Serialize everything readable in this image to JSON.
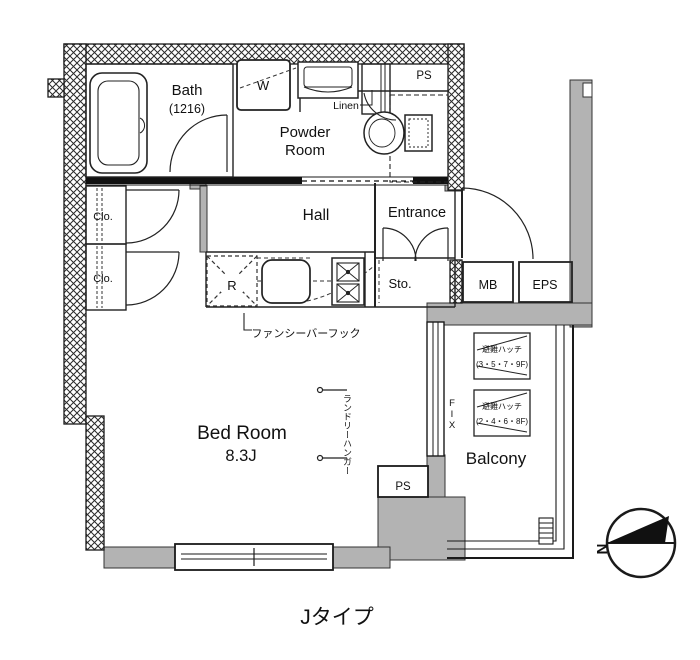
{
  "title": "Jタイプ",
  "labels": {
    "bath": "Bath",
    "bath_size": "(1216)",
    "powder_line1": "Powder",
    "powder_line2": "Room",
    "washer": "W",
    "linen": "Linen",
    "ps_top": "PS",
    "hall": "Hall",
    "entrance": "Entrance",
    "closet_upper": "Clo.",
    "closet_lower": "Clo.",
    "refrigerator": "R",
    "storage": "Sto.",
    "meter_box": "MB",
    "eps": "EPS",
    "bedroom": "Bed Room",
    "bedroom_size": "8.3J",
    "balcony": "Balcony",
    "ps_bottom": "PS",
    "fix_window": "FIX",
    "fancy_bar_hook": "ファンシーバーフック",
    "laundry_hanger": "ランドリーハンガー",
    "hatch_upper_name": "避難ハッチ",
    "hatch_upper_floors": "(3・5・7・9F)",
    "hatch_lower_name": "避難ハッチ",
    "hatch_lower_floors": "(2・4・6・8F)",
    "compass_north": "N"
  },
  "colors": {
    "wall_gray": "#b3b3b3",
    "line_black": "#1a1a1a",
    "background": "#ffffff"
  }
}
